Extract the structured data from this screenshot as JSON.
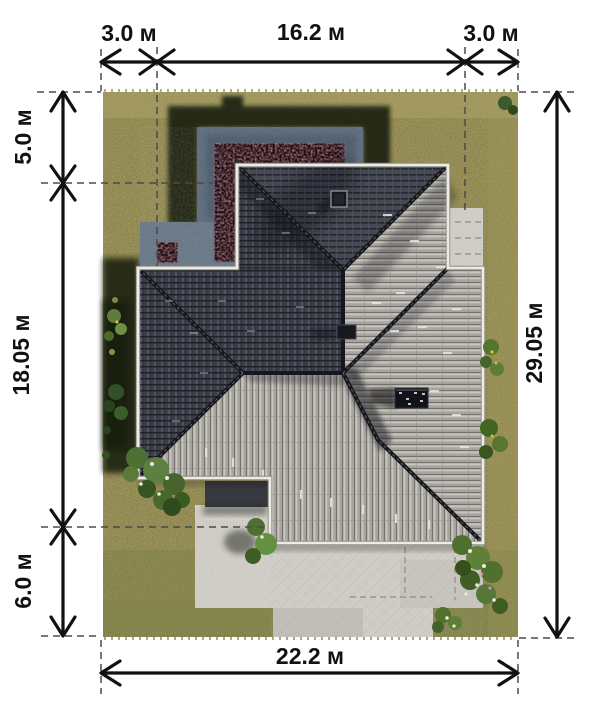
{
  "plan": {
    "type": "site-plan-roof-view",
    "unit": "м",
    "dimensions": {
      "top": [
        "3.0 м",
        "16.2 м",
        "3.0 м"
      ],
      "left": [
        "5.0 м",
        "18.05 м",
        "6.0 м"
      ],
      "right": [
        "29.05 м"
      ],
      "bottom": [
        "22.2 м"
      ]
    }
  },
  "colors": {
    "ink": "#111111",
    "grass": "#9c9259",
    "shadow": "#151a0e",
    "terrace": "#5d6c7f",
    "flower_bed": "#200d12",
    "paving": "#d2cfc9",
    "roof_dark": "#3b3f48",
    "roof_light": "#b2afa9",
    "fascia": "#edebe5"
  }
}
